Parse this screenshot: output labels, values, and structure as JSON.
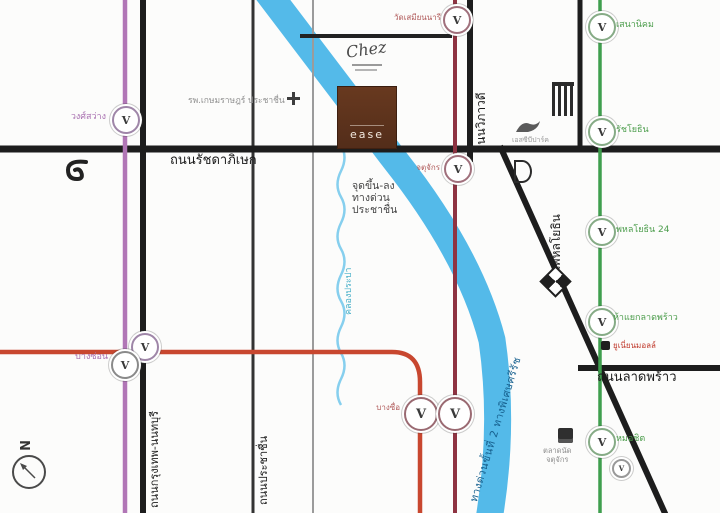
{
  "compass": {
    "north_label": "N"
  },
  "station_glyph": "V",
  "roads": {
    "ratchadaphisek": "ถนนรัชดาภิเษก",
    "vibhavadi": "ถนนวิภาวดี",
    "phahonyothin": "ถนนพหลโยธิน",
    "lat_phrao": "ถนนลาดพร้าว",
    "krungthep_nonthaburi": "ถนนกรุงเทพ-นนทบุรี",
    "prachachuen": "ถนนประชาชื่น"
  },
  "waterway": {
    "canal_label": "คลองประปา"
  },
  "expressway": {
    "band_label": "ทางด่วนขั้นที่ 2 ทางพิเศษศรีรัช",
    "note_line1": "จุดขึ้น-ลง",
    "note_line2": "ทางด่วน",
    "note_line3": "ประชาชื่น"
  },
  "transit": {
    "purple_line": {
      "color": "#b176b6",
      "stations": [
        {
          "label": "วงศ์สว่าง"
        },
        {
          "label": "บางซ่อน"
        }
      ]
    },
    "dark_red_line": {
      "color": "#8e3342",
      "stations": [
        {
          "label": "วัดเสมียนนารี"
        },
        {
          "label": "จตุจักร"
        },
        {
          "label": "บางซื่อ"
        }
      ]
    },
    "orange_line": {
      "color": "#c8472f"
    },
    "green_line": {
      "color": "#3f9e4e",
      "stations": [
        {
          "label": "เสนานิคม"
        },
        {
          "label": "รัชโยธิน"
        },
        {
          "label": "พหลโยธิน 24"
        },
        {
          "label": "ห้าแยกลาดพร้าว"
        },
        {
          "label": "หมอชิต"
        }
      ]
    }
  },
  "landmarks": {
    "hospital": "รพ.เกษมราษฎร์ ประชาชื่น",
    "scb_park": "เอสซีบีปาร์ค",
    "union_mall": "ยูเนี่ยนมอลล์",
    "market_line1": "ตลาดนัด",
    "market_line2": "จตุจักร"
  },
  "project": {
    "script_text": "Chez",
    "logo_text": "ease"
  },
  "colors": {
    "road": "#1d1d1d",
    "expressway_band": "#45b4e7",
    "canal": "#86cfee",
    "project_brown": "#5d3324"
  }
}
